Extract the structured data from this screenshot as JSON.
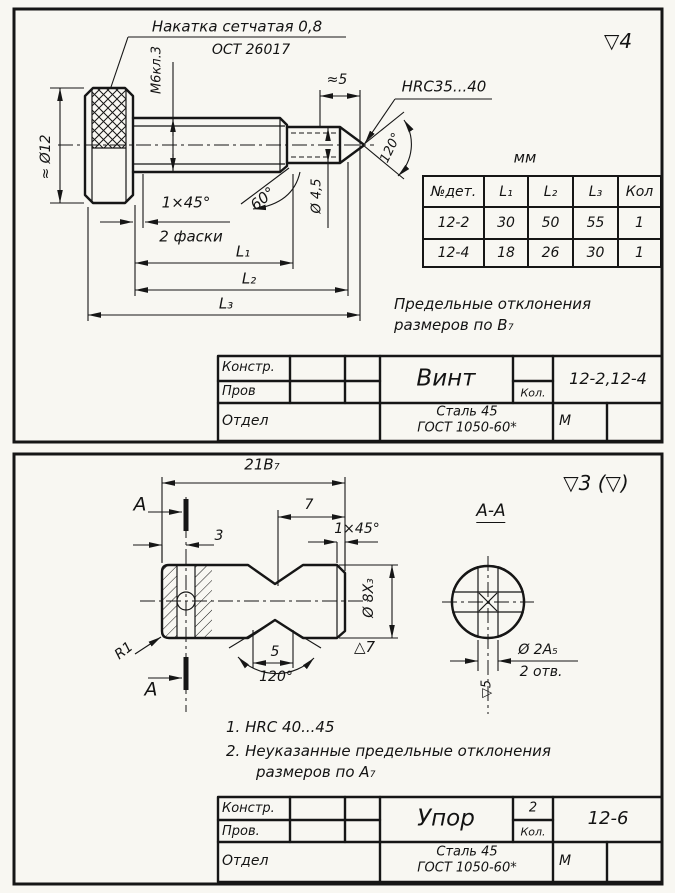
{
  "accent_ink": "#161616",
  "paper": "#f8f7f2",
  "top": {
    "frame_mark": "▽4",
    "knurl_note1": "Накатка сетчатая 0,8",
    "knurl_note2": "ОСТ 26017",
    "dims": {
      "dia_head": "≈ Ø12",
      "thread": "М6кл.3",
      "tip_len": "≈5",
      "hardness": "HRC35...40",
      "tip_angle": "120°",
      "dia_tip": "Ø 4,5",
      "cone_angle": "60°",
      "chamfer": "1×45°",
      "chamfer_note": "2 фаски",
      "l1": "L₁",
      "l2": "L₂",
      "l3": "L₃"
    },
    "table": {
      "unit": "мм",
      "headers": [
        "№дет.",
        "L₁",
        "L₂",
        "L₃",
        "Кол"
      ],
      "rows": [
        [
          "12-2",
          "30",
          "50",
          "55",
          "1"
        ],
        [
          "12-4",
          "18",
          "26",
          "30",
          "1"
        ]
      ]
    },
    "tolerance_note1": "Предельные отклонения",
    "tolerance_note2": "размеров по В₇",
    "tb": {
      "konstr": "Констр.",
      "prov": "Пров",
      "otdel": "Отдел",
      "name": "Винт",
      "kol": "Кол.",
      "number": "12-2,12-4",
      "mat1": "Сталь 45",
      "mat2": "ГОСТ 1050-60*",
      "scale": "М"
    }
  },
  "bottom": {
    "frame_mark": "▽3 (▽)",
    "dims": {
      "len": "21В₇",
      "sec_a": "А",
      "d3": "3",
      "d7": "7",
      "chamfer": "1×45°",
      "dia8": "Ø 8Х₃",
      "tri7": "△7",
      "r1": "R1",
      "d5": "5",
      "groove_angle": "120°",
      "section_title": "А-А",
      "dia2": "Ø 2А₅",
      "holes": "2 отв.",
      "mark5": "▽5"
    },
    "notes": [
      "1.  HRC 40...45",
      "2.  Неуказанные предельные отклонения",
      "размеров по А₇"
    ],
    "tb": {
      "konstr": "Констр.",
      "prov": "Пров.",
      "otdel": "Отдел",
      "name": "Упор",
      "kol_val": "2",
      "kol": "Кол.",
      "number": "12-6",
      "mat1": "Сталь 45",
      "mat2": "ГОСТ 1050-60*",
      "scale": "М"
    }
  }
}
